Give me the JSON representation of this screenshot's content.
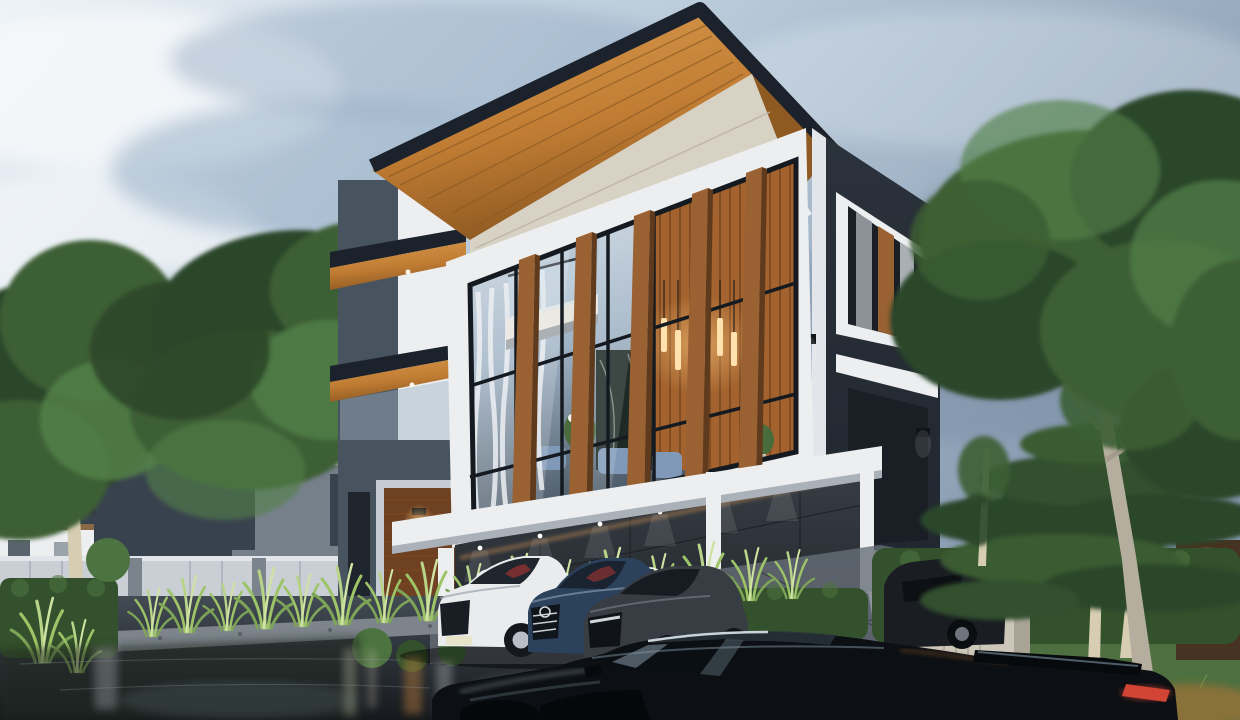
{
  "meta": {
    "title": "Modern three-story house exterior render at dusk",
    "scene_type": "architectural-3d-render"
  },
  "palette": {
    "sky_light": "#eef3f7",
    "sky_mid": "#b9cada",
    "sky_slate": "#8296ac",
    "cloud_white": "#f4f7fa",
    "cloud_shadow": "#97aec6",
    "roof_fascia": "#1b222c",
    "wood_light": "#d99b4e",
    "wood_mid": "#c07c33",
    "wood_dark": "#8f5a22",
    "white_wall": "#eceef0",
    "white_shade": "#c6ccd3",
    "beige_band": "#d8d2c4",
    "charcoal": "#2b323b",
    "charcoal_dark": "#1f252d",
    "glass_high": "#dbe5ee",
    "glass_low": "#9fb2c4",
    "glass_dark": "#44525f",
    "mullion": "#151a20",
    "fin_light": "#9a6233",
    "fin_dark": "#5f3a1c",
    "interior_wood": "#a4632e",
    "interior_wood_dark": "#7b4820",
    "ceiling_warm": "#e5decf",
    "marble": "#1e2a26",
    "lamp_glow": "#ffc97e",
    "lamp_bar": "#ffe2ad",
    "curtain": "#e9edf1",
    "sofa_blue": "#8099b8",
    "flower_white": "#f3f4ef",
    "plant_green": "#4a6b3c",
    "stone_panel": "#47535f",
    "slat_door": "#6e4123",
    "sconce_warm": "#f2a75a",
    "carport_wall": "#383e45",
    "carport_wall_dark": "#22272d",
    "bg_house": "#4a5664",
    "bg_house_light": "#76808a",
    "bg_house_dark": "#38424e",
    "fence": "#c9cfd5",
    "fence_cap": "#e2e6ea",
    "fence_post": "#7b838c",
    "tree_dark": "#2c462a",
    "tree_mid": "#3c5e34",
    "tree_light": "#538048",
    "birch": "#d6cdb2",
    "hedge": "#33512c",
    "hedge_light": "#4c7340",
    "grass_blade": "#9ec468",
    "lawn": "#4e7040",
    "pave_light": "#666e77",
    "pave_mid": "#434b54",
    "pave_dark": "#16191d",
    "gravel": "#7d848b",
    "pillar_beige": "#cdc7ba",
    "curb_stone": "#8f959b",
    "car_white": "#e9ebed",
    "car_blue": "#2c415c",
    "car_gray": "#383d43",
    "car_black": "#0c0f13",
    "car_highlight": "#dbe5ec",
    "wheel_silver": "#b9bfc6",
    "tail_red": "#d24534",
    "plate": "#e8e4c9",
    "interior_red": "#8e3230",
    "wall_brown": "#463321",
    "furniture_white": "#eef1f3",
    "toy_wood": "#8a5a34"
  }
}
